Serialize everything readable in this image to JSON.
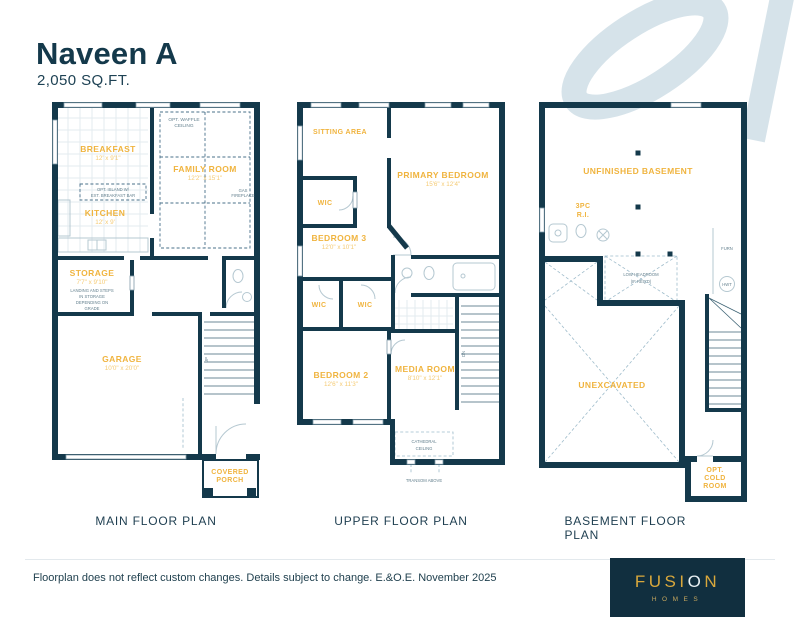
{
  "header": {
    "title": "Naveen A",
    "sqft": "2,050 SQ.FT."
  },
  "plans": {
    "main": {
      "caption": "MAIN FLOOR PLAN",
      "breakfast": {
        "name": "BREAKFAST",
        "dim": "12' x 9'1\""
      },
      "family": {
        "name": "FAMILY ROOM",
        "dim": "12'2\" x 15'1\""
      },
      "kitchen": {
        "name": "KITCHEN",
        "dim": "12' x 9'"
      },
      "storage": {
        "name": "STORAGE",
        "dim": "7'7\" x 9'10\"",
        "note1": "LANDING AND STEPS",
        "note2": "IN STORAGE",
        "note3": "DEPENDING ON",
        "note4": "GRADE"
      },
      "garage": {
        "name": "GARAGE",
        "dim": "10'0\" x 20'0\""
      },
      "porch": {
        "name1": "COVERED",
        "name2": "PORCH"
      },
      "waffle1": "OPT. WAFFLE",
      "waffle2": "CEILING",
      "island1": "OPT. ISLAND W/",
      "island2": "EXT. BREAKFAST BAR",
      "fireplace1": "GAS",
      "fireplace2": "FIREPLACE",
      "stair": "UP"
    },
    "upper": {
      "caption": "UPPER FLOOR PLAN",
      "sitting": {
        "name": "SITTING AREA"
      },
      "wic1": {
        "name": "WIC"
      },
      "primary": {
        "name": "PRIMARY BEDROOM",
        "dim": "15'6\" x 12'4\""
      },
      "bedroom3": {
        "name": "BEDROOM 3",
        "dim": "12'0\" x 10'1\""
      },
      "wic2": {
        "name": "WIC"
      },
      "wic3": {
        "name": "WIC"
      },
      "bedroom2": {
        "name": "BEDROOM 2",
        "dim": "12'6\" x 11'3\""
      },
      "media": {
        "name": "MEDIA ROOM",
        "dim": "8'10\" x 12'1\""
      },
      "cathedral1": "CATHEDRAL",
      "cathedral2": "CEILING",
      "transom": "TRANSOM ABOVE",
      "stair": "DN"
    },
    "basement": {
      "caption": "BASEMENT FLOOR PLAN",
      "unfinished": {
        "name": "UNFINISHED BASEMENT"
      },
      "threepc1": "3PC",
      "threepc2": "R.I.",
      "unexcavated": {
        "name": "UNEXCAVATED"
      },
      "lowhead1": "LOW HEADROOM",
      "lowhead2": "(IF REQ'D)",
      "furn": "FURN",
      "hwt": "HWT",
      "cold1": "OPT.",
      "cold2": "COLD",
      "cold3": "ROOM"
    }
  },
  "footer": {
    "disclaimer": "Floorplan does not reflect custom changes. Details subject to change. E.&O.E. November 2025",
    "logo": {
      "part1": "FUSI",
      "o": "O",
      "part2": "N",
      "sub": "HOMES"
    }
  },
  "colors": {
    "navy": "#14394B",
    "gold": "#F0B43F",
    "line": "#B5C8D1",
    "swirl": "#D6E3EA"
  }
}
